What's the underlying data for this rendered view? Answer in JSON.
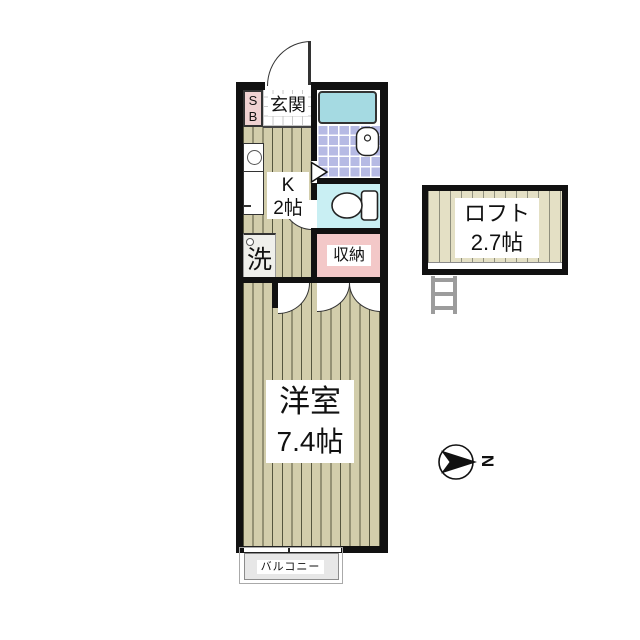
{
  "plan": {
    "shoe_box": {
      "line1": "S",
      "line2": "B"
    },
    "entrance": {
      "label": "玄関"
    },
    "kitchen": {
      "name": "K",
      "size": "2帖"
    },
    "laundry": {
      "label": "洗"
    },
    "closet": {
      "label": "収納"
    },
    "main_room": {
      "name": "洋室",
      "size": "7.4帖"
    },
    "balcony": {
      "label": "バルコニー"
    },
    "loft": {
      "name": "ロフト",
      "size": "2.7帖"
    },
    "compass": {
      "north": "N"
    }
  },
  "colors": {
    "wall": "#111111",
    "floor_stripe_bg": "#d2cdab",
    "floor_stripe_line": "#55553e",
    "loft_stripe_bg": "#e4e0c5",
    "loft_stripe_line": "#8f8f7d",
    "bathtub": "#a5dae2",
    "bath_tile": "#b6bae4",
    "toilet_floor": "#c9eff3",
    "closet_pink": "#f3c8c8",
    "shoe_box_pink": "#f0d2d2",
    "laundry_box": "#efefeb",
    "balcony_gray": "#e7e7e7"
  }
}
